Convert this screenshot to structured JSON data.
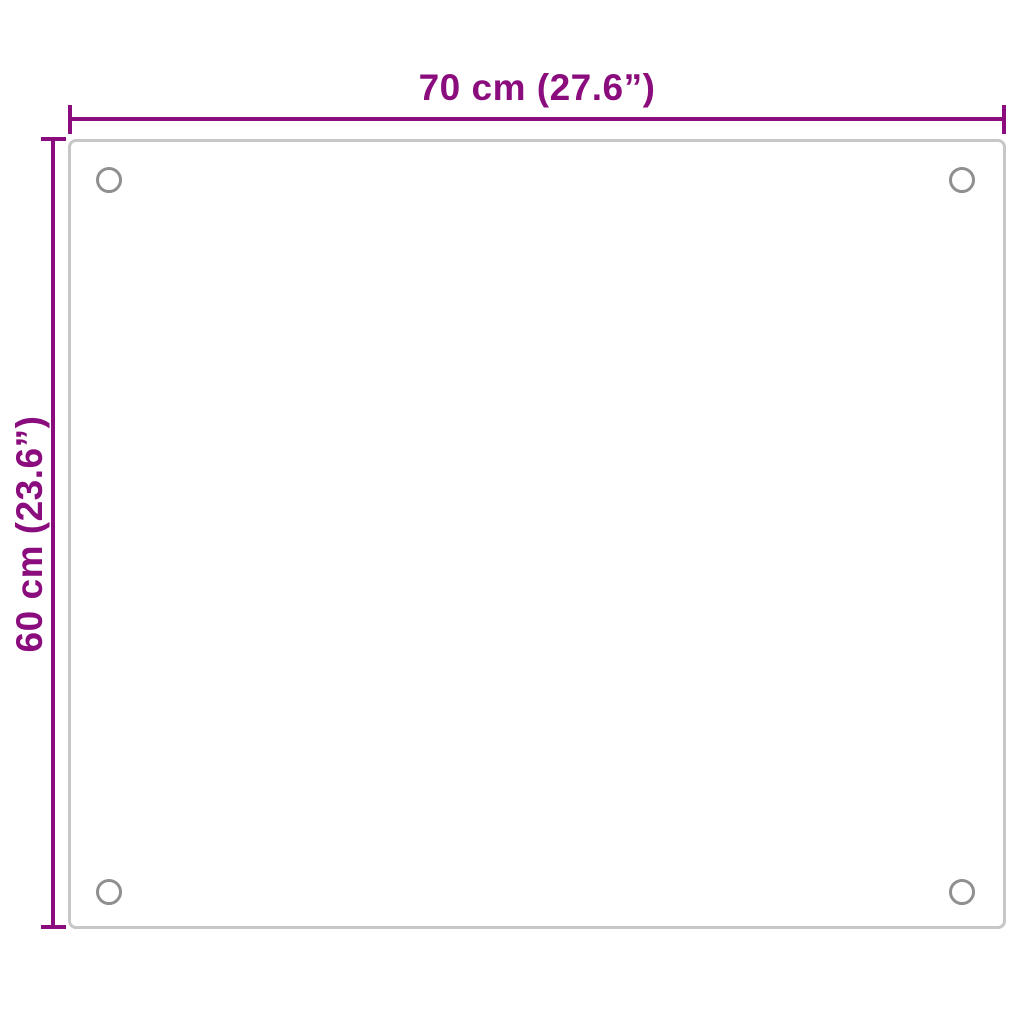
{
  "diagram": {
    "width_label": "70 cm (27.6”)",
    "height_label": "60 cm (23.6”)",
    "panel": {
      "shape": "rectangle-with-rounded-corners",
      "mounting_holes_count": 4
    }
  },
  "colors": {
    "accent": "#8A0C7D",
    "panel_border": "#C7C7C7",
    "hole_ring": "#8F8F8F",
    "background": "#FFFFFF"
  }
}
